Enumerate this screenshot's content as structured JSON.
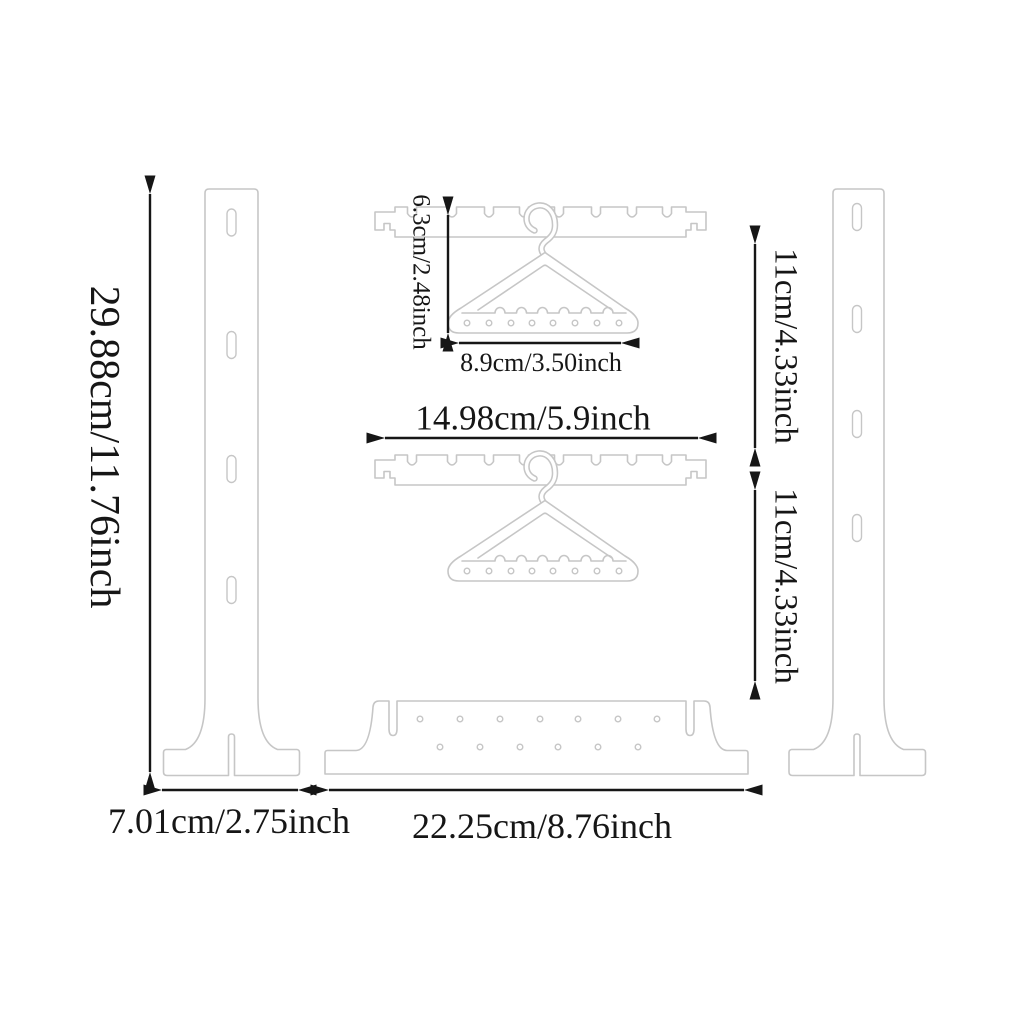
{
  "diagram": {
    "colors": {
      "outline": "#c6c6c6",
      "dimension": "#161616",
      "background": "#ffffff"
    },
    "labels": {
      "panel_height": "29.88cm/11.76inch",
      "foot_width": "7.01cm/2.75inch",
      "base_width": "22.25cm/8.76inch",
      "bar_width": "14.98cm/5.9inch",
      "hanger_width": "8.9cm/3.50inch",
      "hanger_height": "6.3cm/2.48inch",
      "tier_gap_upper": "11cm/4.33inch",
      "tier_gap_lower": "11cm/4.33inch"
    }
  }
}
